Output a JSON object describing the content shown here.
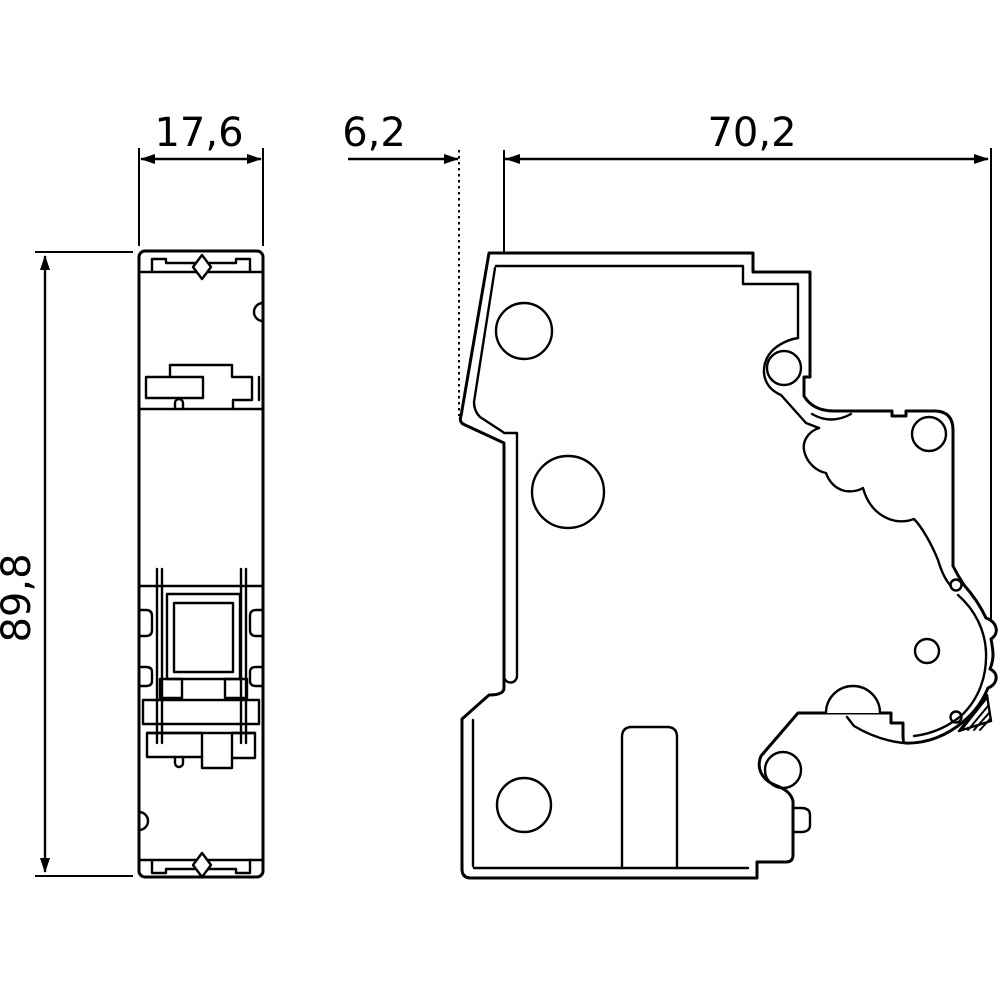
{
  "drawing": {
    "background_color": "#ffffff",
    "line_color": "#000000",
    "dimensions": {
      "height": {
        "label": "89,8",
        "value": 89.8,
        "orientation": "vertical"
      },
      "front_width": {
        "label": "17,6",
        "value": 17.6,
        "orientation": "horizontal"
      },
      "nose_depth": {
        "label": "6,2",
        "value": 6.2,
        "orientation": "horizontal"
      },
      "body_depth": {
        "label": "70,2",
        "value": 70.2,
        "orientation": "horizontal"
      }
    }
  }
}
